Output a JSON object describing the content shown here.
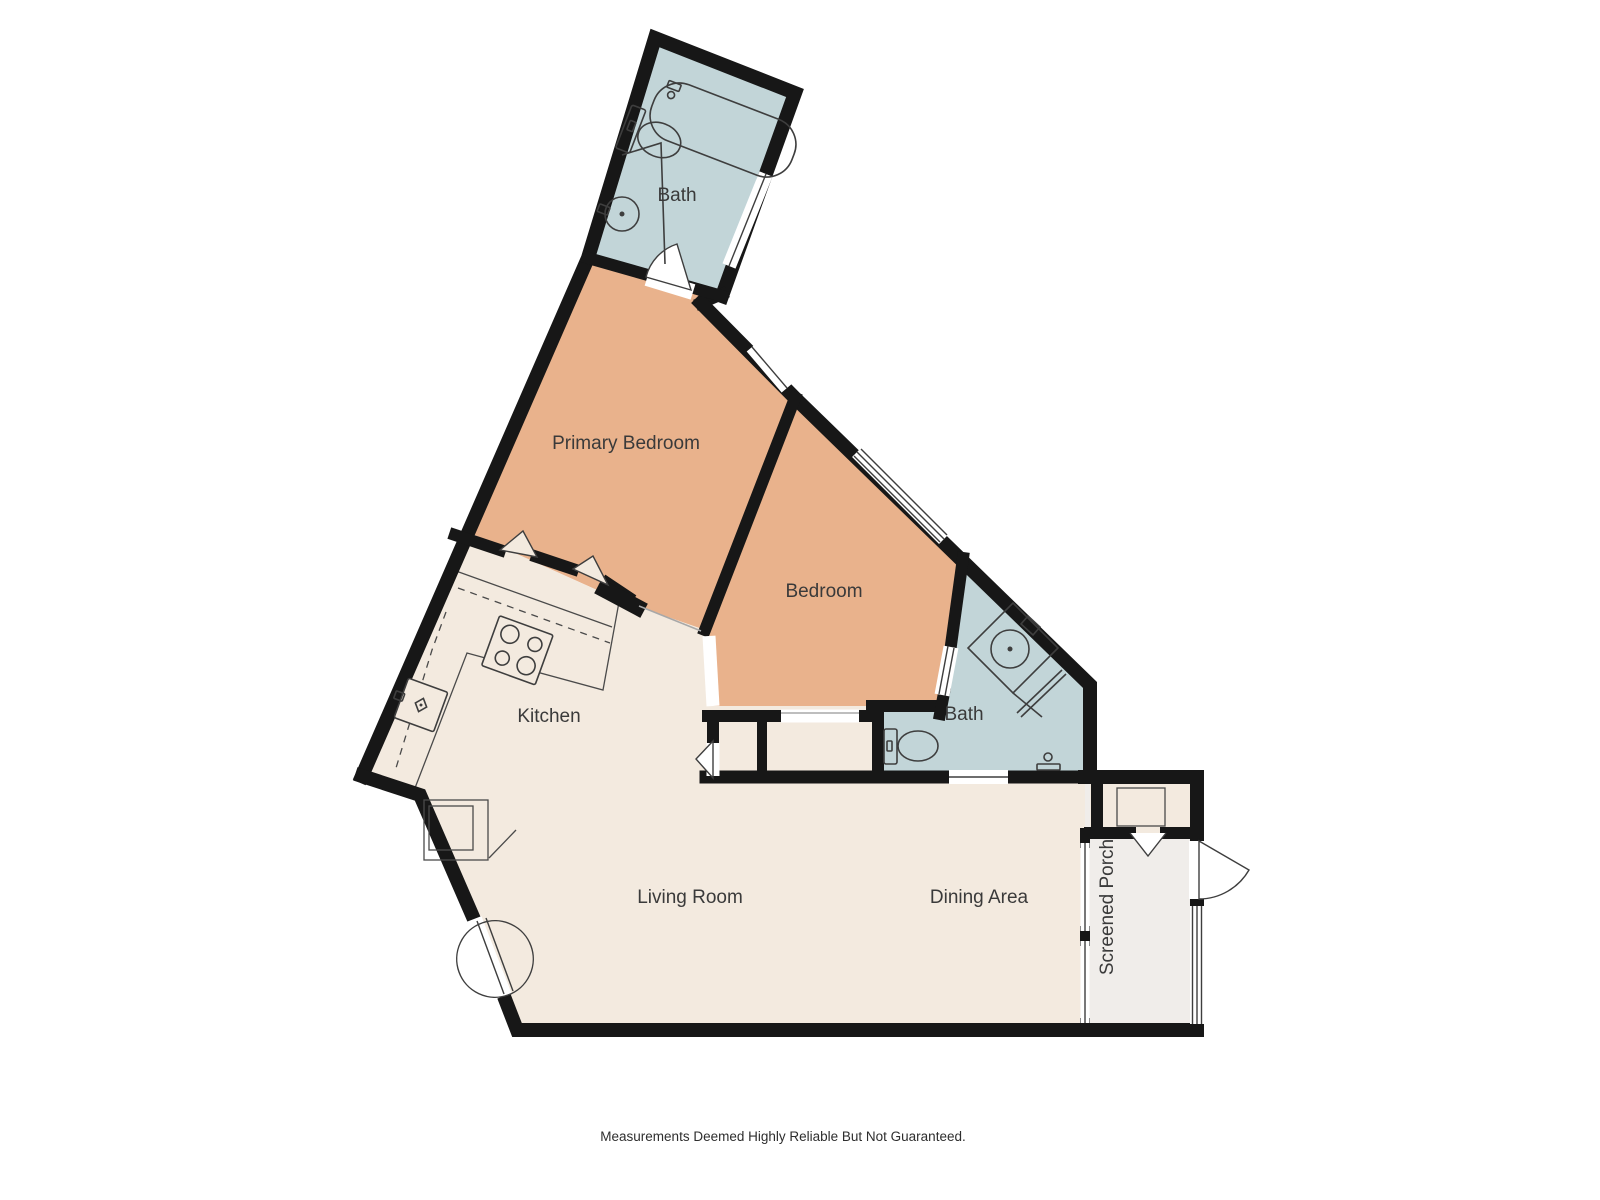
{
  "palette": {
    "wall": "#171717",
    "bedroom": "#E9B28C",
    "bath": "#C2D5D8",
    "living": "#F3EADF",
    "porch": "#F0EDEA",
    "fixture": "#3E3E3E",
    "label": "#3A3A3A"
  },
  "rooms": {
    "bath_top": {
      "label": "Bath"
    },
    "primary_bedroom": {
      "label": "Primary Bedroom"
    },
    "bedroom": {
      "label": "Bedroom"
    },
    "kitchen": {
      "label": "Kitchen"
    },
    "bath_right": {
      "label": "Bath"
    },
    "living_room": {
      "label": "Living Room"
    },
    "dining_area": {
      "label": "Dining Area"
    },
    "screened_porch": {
      "label": "Screened Porch"
    }
  },
  "fixtures": {
    "top_bath": [
      "bathtub",
      "toilet",
      "sink"
    ],
    "right_bath": [
      "corner-vanity-sink",
      "toilet",
      "shower"
    ],
    "kitchen": [
      "stove",
      "sink",
      "counters"
    ]
  },
  "footer": {
    "disclaimer": "Measurements Deemed Highly Reliable But Not Guaranteed."
  }
}
